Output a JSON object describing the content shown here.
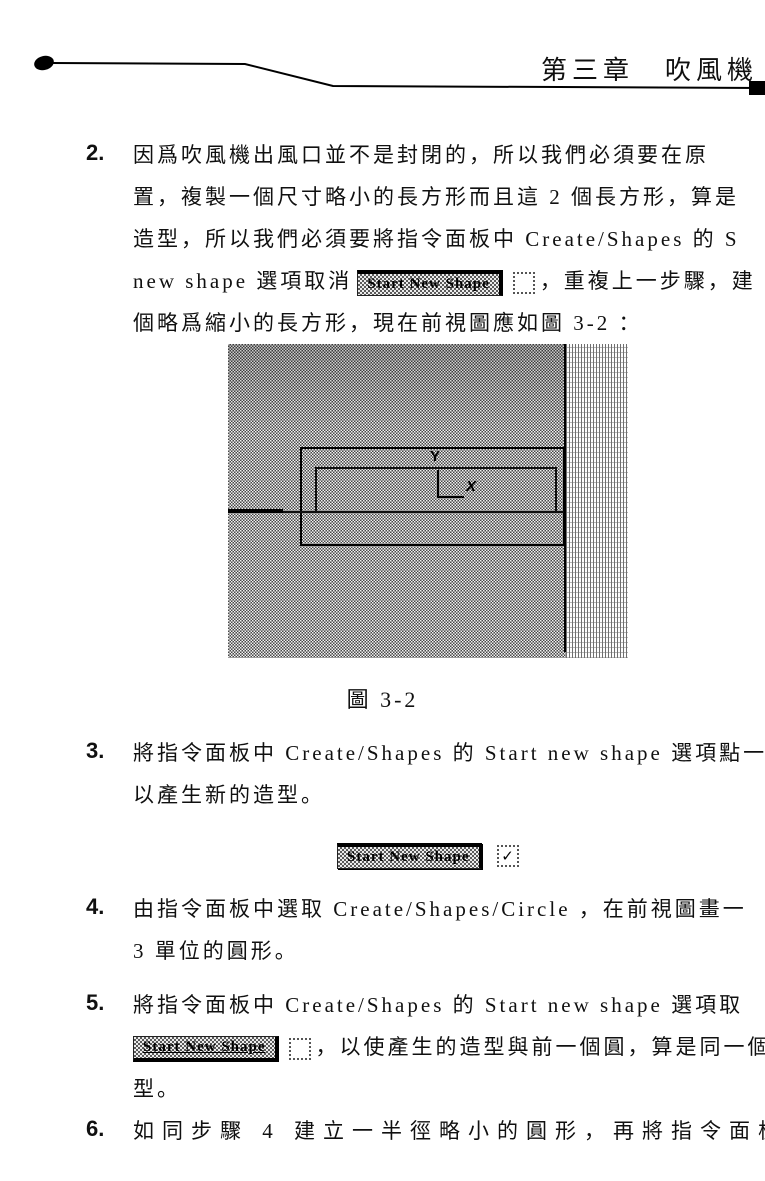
{
  "header": {
    "title": "第三章　吹風機"
  },
  "controls": {
    "start_new_shape_label": "Start New Shape",
    "checkmark": "✓"
  },
  "figure": {
    "caption": "圖 3-2",
    "axis_y": "Y",
    "axis_x": "X"
  },
  "steps": {
    "s2": {
      "num": "2.",
      "l1": "因爲吹風機出風口並不是封閉的，所以我們必須要在原",
      "l2": "置，複製一個尺寸略小的長方形而且這 2 個長方形，算是",
      "l3": "造型，所以我們必須要將指令面板中 Create/Shapes 的 S",
      "l4_pre": "new shape 選項取消",
      "l4_post": "，重複上一步驟，建",
      "l5": "個略爲縮小的長方形，現在前視圖應如圖 3-2 ："
    },
    "s3": {
      "num": "3.",
      "l1": "將指令面板中 Create/Shapes 的 Start new shape 選項點一",
      "l2": "以產生新的造型。"
    },
    "s4": {
      "num": "4.",
      "l1": "由指令面板中選取 Create/Shapes/Circle ，在前視圖畫一",
      "l2": "3 單位的圓形。"
    },
    "s5": {
      "num": "5.",
      "l1": "將指令面板中 Create/Shapes 的 Start new shape 選項取",
      "l2_post": "，以使產生的造型與前一個圓，算是同一個",
      "l3": "型。"
    },
    "s6": {
      "num": "6.",
      "l1": "如同步驟 4 建立一半徑略小的圓形，再將指令面板"
    }
  }
}
